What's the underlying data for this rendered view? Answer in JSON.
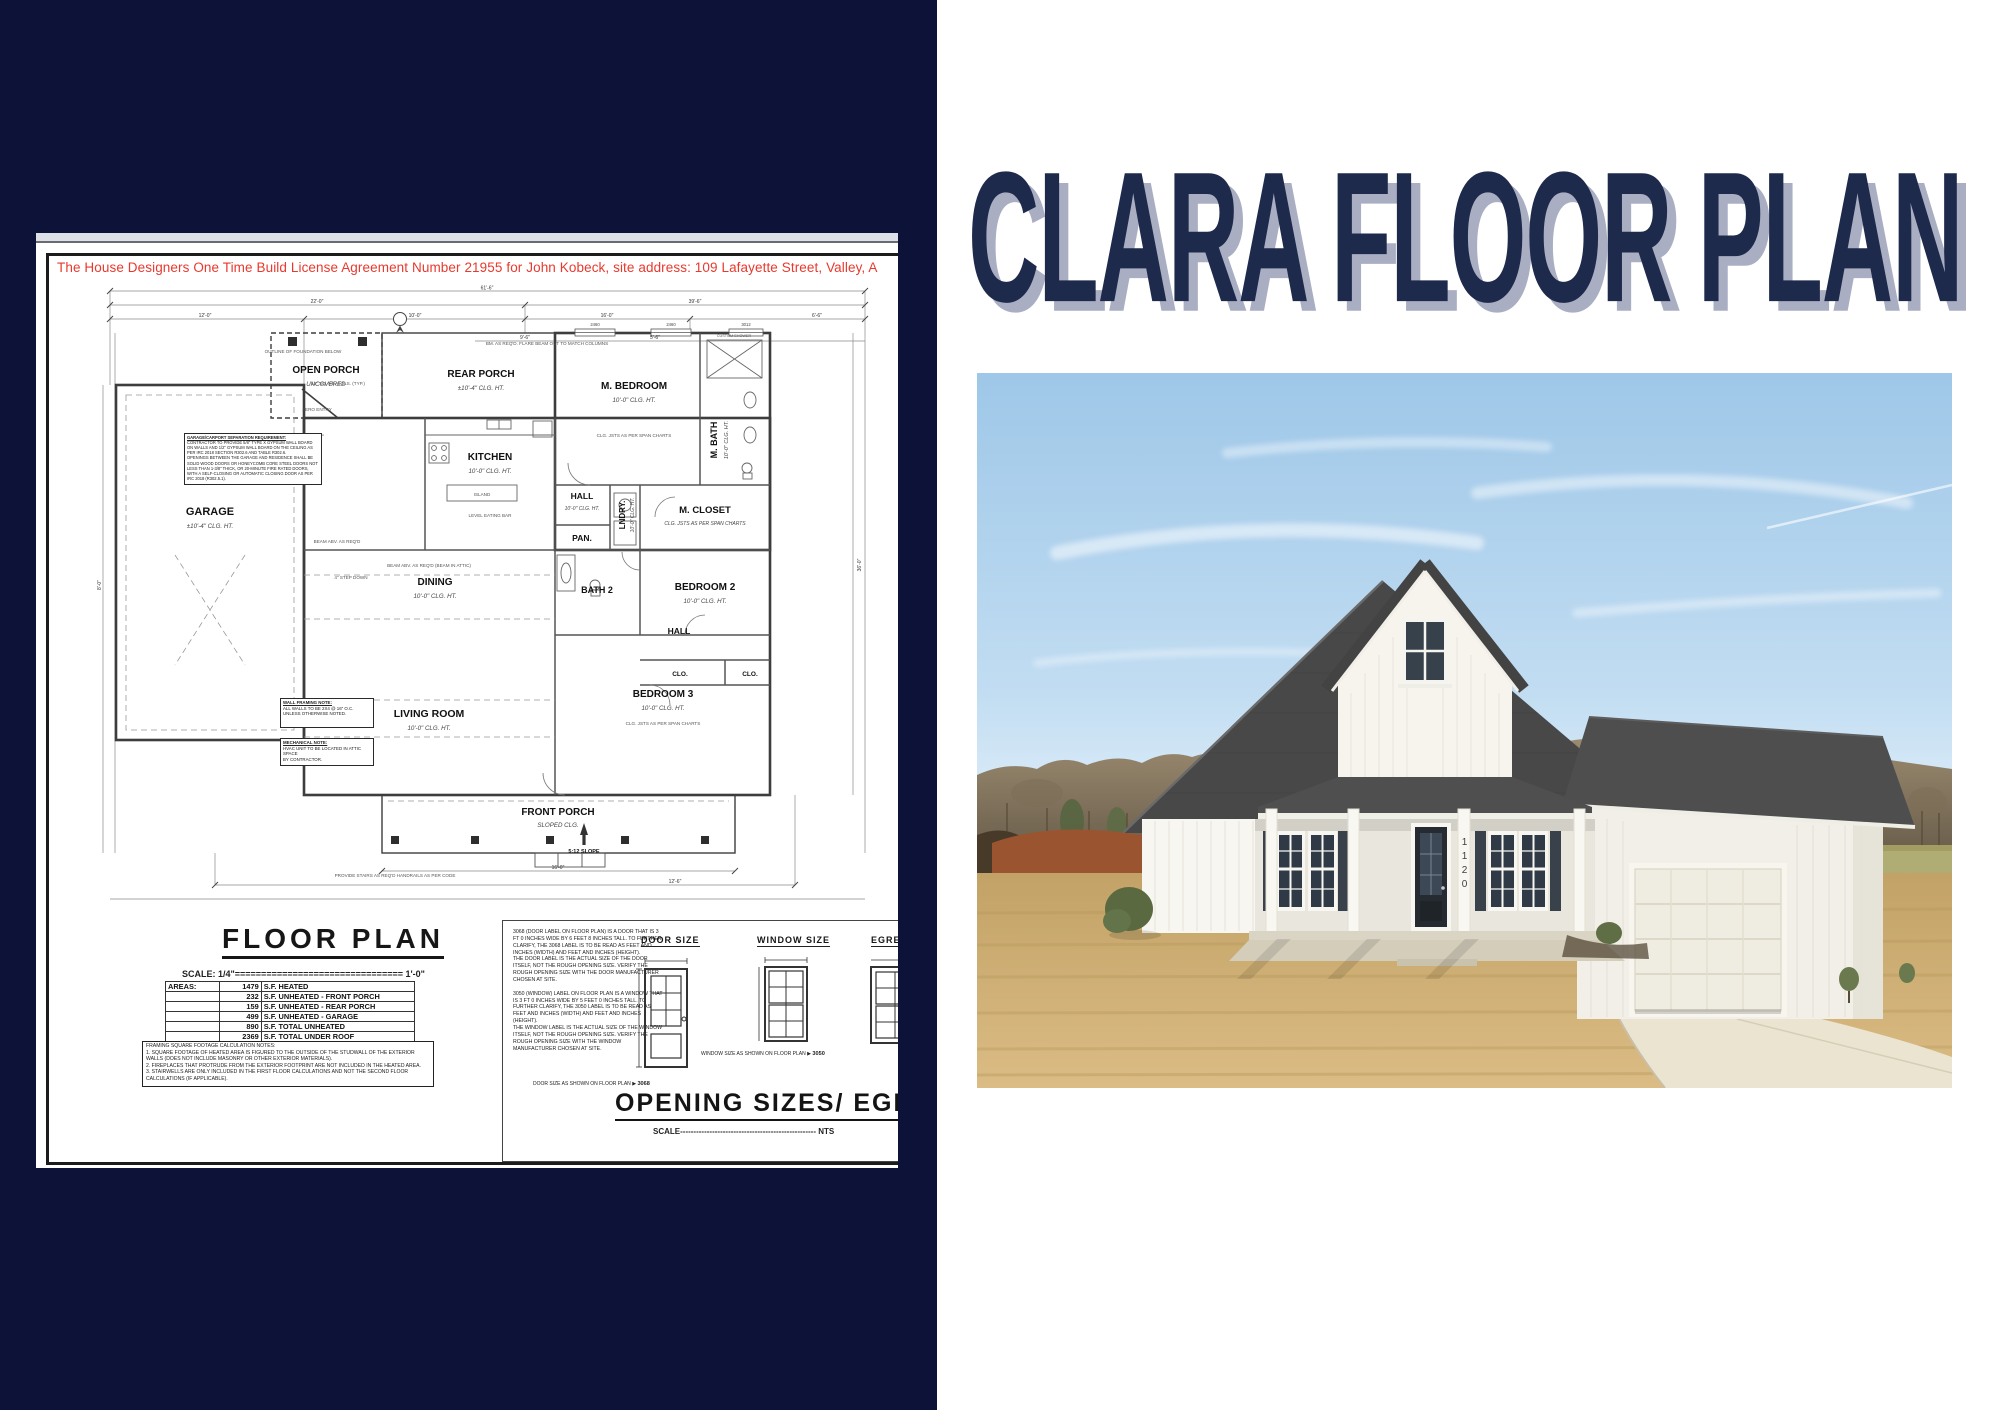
{
  "colors": {
    "panel_navy": "#0d1239",
    "title_navy": "#1e2a4b",
    "title_shadow": "#a9aec2",
    "license_red": "#e8392e",
    "sky_blue": "#a9cdeb",
    "roof_gray": "#484848",
    "lawn_tan": "#c9a76a",
    "house_white": "#f6f4ed"
  },
  "left_panel": {
    "license_text": "The House Designers One Time Build License Agreement Number 21955 for John Kobeck, site address: 109 Lafayette Street, Valley, A",
    "plan": {
      "rooms": [
        {
          "label": "OPEN PORCH",
          "sub": "UNCOVERED"
        },
        {
          "label": "REAR PORCH",
          "sub": "±10'-4\" CLG. HT."
        },
        {
          "label": "M. BEDROOM",
          "sub": "10'-0\" CLG. HT."
        },
        {
          "label": "M. BATH",
          "sub": "10'-0\" CLG. HT."
        },
        {
          "label": "M. CLOSET",
          "sub": "CLG. JSTS AS PER SPAN CHARTS"
        },
        {
          "label": "KITCHEN",
          "sub": "10'-0\" CLG. HT."
        },
        {
          "label": "HALL",
          "sub": "10'-0\" CLG. HT."
        },
        {
          "label": "LNDRY.",
          "sub": "10'-0\" CLG. HT."
        },
        {
          "label": "PAN.",
          "sub": ""
        },
        {
          "label": "GARAGE",
          "sub": "±10'-4\" CLG. HT."
        },
        {
          "label": "DINING",
          "sub": "10'-0\" CLG. HT."
        },
        {
          "label": "BATH 2",
          "sub": ""
        },
        {
          "label": "BEDROOM 2",
          "sub": "10'-0\" CLG. HT."
        },
        {
          "label": "HALL",
          "sub": ""
        },
        {
          "label": "CLO.",
          "sub": ""
        },
        {
          "label": "CLO.",
          "sub": ""
        },
        {
          "label": "BEDROOM 3",
          "sub": "10'-0\" CLG. HT."
        },
        {
          "label": "LIVING ROOM",
          "sub": "10'-0\" CLG. HT."
        },
        {
          "label": "FRONT PORCH",
          "sub": "SLOPED CLG."
        },
        {
          "label": "5:12 SLOPE",
          "sub": ""
        }
      ],
      "window_tags": [
        "2460",
        "2460",
        "3012"
      ],
      "dimension_labels": [
        "61'-6\"",
        "22'-0\"",
        "39'-6\"",
        "12'-0\"",
        "10'-0\"",
        "16'-0\"",
        "6'-6\"",
        "9'-6\"",
        "5'-6\"",
        "16'-0\"",
        "12'-6\"",
        "8'-0\"",
        "36'-0\""
      ],
      "annotations": [
        {
          "text": "OUTLINE OF FOUNDATION BELOW"
        },
        {
          "text": "BM. AS REQ'D. FLARE BEAM OUT TO MATCH COLUMNS"
        },
        {
          "text": "12\" SQ. HB. COLS. (TYP.)"
        },
        {
          "text": "ZERO ENTRY"
        },
        {
          "text": "CLG. JSTS AS PER SPAN CHARTS"
        },
        {
          "text": "LEVEL EATING BAR"
        },
        {
          "text": "ISLAND"
        },
        {
          "text": "BEAM ABV. AS REQ'D (BEAM IN ATTIC)"
        },
        {
          "text": "BEAM ABV. AS REQ'D"
        },
        {
          "text": "4\" STEP DOWN"
        },
        {
          "text": "PROVIDE STAIRS AS REQ'D HANDRAILS AS PER CODE"
        },
        {
          "text": "CUSTOM SHOWER"
        },
        {
          "text": "CLG. JSTS AS PER SPAN CHARTS"
        }
      ],
      "garage_note": {
        "title": "GARAGE/CARPORT SEPARATION REQUIREMENT:",
        "body": "CONTRACTOR TO PROVIDE 5/8\" TYPE X GYPSUM WALL BOARD ON WALLS AND 1/2\" GYPSUM WALL BOARD ON THE CEILING AS PER IRC 2018 SECTION R302.6 AND TABLE R302.6.\nOPENINGS BETWEEN THE GARAGE AND RESIDENCE SHALL BE SOLID WOOD DOORS OR HONEYCOMB CORE STEEL DOORS NOT LESS THAN 1-3/8\" THICK, OR 20-MINUTE FIRE RATED DOORS, WITH A SELF-CLOSING OR AUTOMATIC CLOSING DOOR AS PER IRC 2018 (R302.5.1)."
      },
      "wall_note": {
        "title": "WALL FRAMING NOTE:",
        "body": "ALL WALLS TO BE 2X4 @ 16\" O.C.\nUNLESS OTHERWISE NOTED."
      },
      "mech_note": {
        "title": "MECHANICAL NOTE:",
        "body": "HVAC UNIT TO BE LOCATED IN ATTIC SPACE\nBY CONTRACTOR."
      }
    },
    "floor_plan_block": {
      "title": "FLOOR PLAN",
      "scale_line": "SCALE: 1/4\"================================ 1'-0\"",
      "areas_label": "AREAS:",
      "areas_rows": [
        {
          "num": "1479",
          "desc": "S.F. HEATED"
        },
        {
          "num": "232",
          "desc": "S.F. UNHEATED - FRONT PORCH"
        },
        {
          "num": "159",
          "desc": "S.F. UNHEATED - REAR PORCH"
        },
        {
          "num": "499",
          "desc": "S.F. UNHEATED - GARAGE"
        },
        {
          "num": "890",
          "desc": "S.F. TOTAL UNHEATED"
        },
        {
          "num": "2369",
          "desc": "S.F. TOTAL UNDER ROOF"
        }
      ],
      "notes": "FRAMING SQUARE FOOTAGE CALCULATION NOTES:\n1. SQUARE FOOTAGE OF HEATED AREA IS FIGURED TO THE OUTSIDE OF THE STUDWALL OF THE EXTERIOR WALLS (DOES NOT INCLUDE MASONRY OR OTHER EXTERIOR MATERIALS).\n2. FIREPLACES THAT PROTRUDE FROM THE EXTERIOR FOOTPRINT ARE NOT INCLUDED IN THE HEATED AREA.\n3. STAIRWELLS ARE ONLY INCLUDED IN THE FIRST FLOOR CALCULATIONS AND NOT THE SECOND FLOOR CALCULATIONS (IF APPLICABLE)."
    },
    "opening_block": {
      "paragraphs": "3068 (DOOR LABEL ON FLOOR PLAN) IS A DOOR THAT IS 3 FT 0 INCHES WIDE BY 6 FEET 8 INCHES TALL. TO FURTHER CLARIFY, THE 3068 LABEL IS TO BE READ AS FEET AND INCHES (WIDTH) AND FEET AND INCHES (HEIGHT).\nTHE DOOR LABEL IS THE ACTUAL SIZE OF THE DOOR ITSELF, NOT THE ROUGH OPENING SIZE. VERIFY THE ROUGH OPENING SIZE WITH THE DOOR MANUFACTURER CHOSEN AT SITE.\n\n3050 (WINDOW) LABEL ON FLOOR PLAN IS A WINDOW THAT IS 3 FT 0 INCHES WIDE BY 5 FEET 0 INCHES TALL. TO FURTHER CLARIFY, THE 3050 LABEL IS TO BE READ AS FEET AND INCHES (WIDTH) AND FEET AND INCHES (HEIGHT).\nTHE WINDOW LABEL IS THE ACTUAL SIZE OF THE WINDOW ITSELF, NOT THE ROUGH OPENING SIZE. VERIFY THE ROUGH OPENING SIZE WITH THE WINDOW MANUFACTURER CHOSEN AT SITE.",
      "door_heading": "DOOR SIZE",
      "window_heading": "WINDOW SIZE",
      "egress_heading": "EGRESS",
      "door_caption": "DOOR SIZE AS SHOWN ON FLOOR PLAN",
      "door_tag": "3068",
      "window_caption": "WINDOW SIZE AS SHOWN ON FLOOR PLAN",
      "window_tag": "3050",
      "title": "OPENING SIZES/ EGRESS",
      "scale_line": "SCALE--------------------------------------------------- NTS"
    }
  },
  "right_panel": {
    "title": "CLARA FLOOR PLAN",
    "house_number": "1120"
  }
}
